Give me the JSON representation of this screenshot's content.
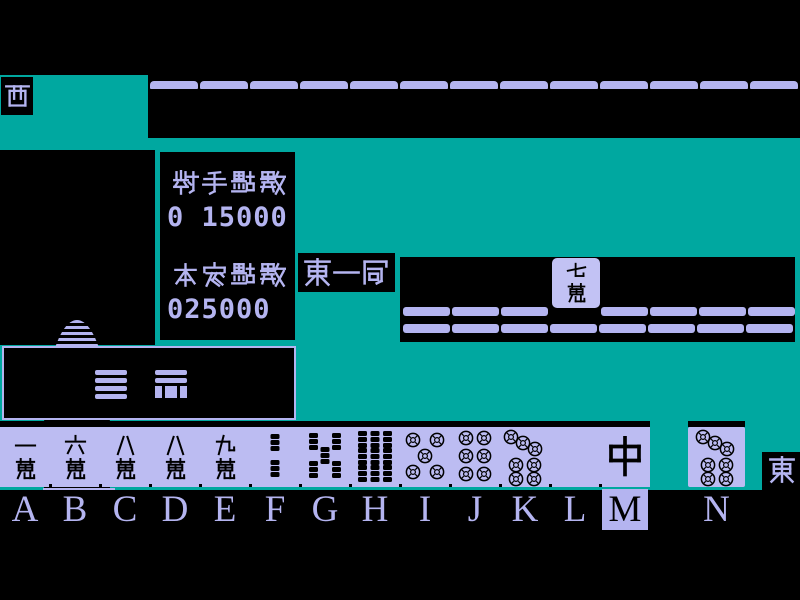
{
  "colors": {
    "background_teal": "#00a8a0",
    "panel_black": "#000000",
    "tile_lavender": "#b4b4f0"
  },
  "winds": {
    "left_player": "西",
    "self_player": "東"
  },
  "round": {
    "label": "東一局"
  },
  "scores": {
    "opponent_label": "對手點數",
    "opponent_value": "0 15000",
    "self_label": "本家點數",
    "self_value": "025000"
  },
  "opponent": {
    "hand_tile_count": 13,
    "discard": {
      "standing_tile": {
        "label": "七萬",
        "suit": "man",
        "value": 7
      },
      "row1_left_count": 3,
      "row1_right_count": 4,
      "row2_count": 8
    }
  },
  "hand": {
    "tiles": [
      {
        "letter": "A",
        "label": "一萬",
        "suit": "man",
        "value": 1
      },
      {
        "letter": "B",
        "label": "六萬",
        "suit": "man",
        "value": 6
      },
      {
        "letter": "C",
        "label": "八萬",
        "suit": "man",
        "value": 8
      },
      {
        "letter": "D",
        "label": "八萬",
        "suit": "man",
        "value": 8
      },
      {
        "letter": "E",
        "label": "九萬",
        "suit": "man",
        "value": 9
      },
      {
        "letter": "F",
        "label": "二索",
        "suit": "sou",
        "value": 2
      },
      {
        "letter": "G",
        "label": "五索",
        "suit": "sou",
        "value": 5
      },
      {
        "letter": "H",
        "label": "九索",
        "suit": "sou",
        "value": 9
      },
      {
        "letter": "I",
        "label": "五筒",
        "suit": "pin",
        "value": 5
      },
      {
        "letter": "J",
        "label": "六筒",
        "suit": "pin",
        "value": 6
      },
      {
        "letter": "K",
        "label": "七筒",
        "suit": "pin",
        "value": 7
      },
      {
        "letter": "L",
        "label": "白",
        "suit": "honor",
        "value": "white"
      },
      {
        "letter": "M",
        "label": "中",
        "suit": "honor",
        "value": "chun"
      }
    ],
    "drawn_tile": {
      "letter": "N",
      "label": "七筒",
      "suit": "pin",
      "value": 7
    },
    "selected_letter": "M"
  }
}
